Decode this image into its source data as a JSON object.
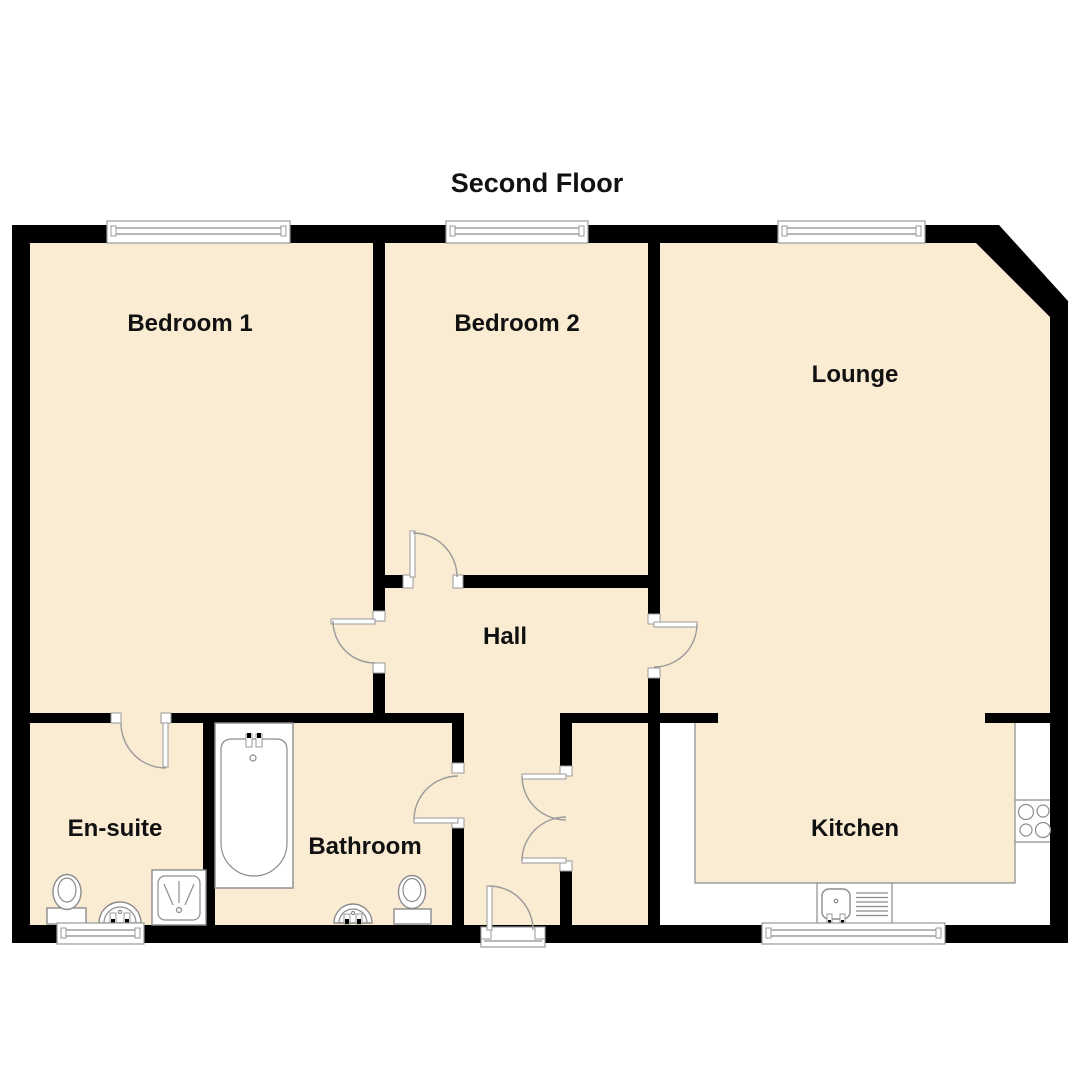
{
  "title": "Second Floor",
  "colors": {
    "floor": "#FAEBD3",
    "wall": "#000000",
    "background": "#FFFFFF",
    "fixture_outline": "#8C8C8C"
  },
  "rooms": {
    "bedroom1": {
      "label": "Bedroom 1"
    },
    "bedroom2": {
      "label": "Bedroom 2"
    },
    "lounge": {
      "label": "Lounge"
    },
    "hall": {
      "label": "Hall"
    },
    "ensuite": {
      "label": "En-suite"
    },
    "bathroom": {
      "label": "Bathroom"
    },
    "kitchen": {
      "label": "Kitchen"
    }
  },
  "fixtures": {
    "ensuite": [
      "toilet",
      "basin",
      "shower"
    ],
    "bathroom": [
      "bathtub",
      "basin",
      "toilet"
    ],
    "kitchen": [
      "counter",
      "sink",
      "drainer",
      "hob"
    ]
  },
  "openings": {
    "windows": [
      "bedroom1-window",
      "bedroom2-window",
      "lounge-window",
      "ensuite-window",
      "kitchen-window"
    ],
    "doors": [
      "ensuite-door",
      "bedroom1-door",
      "bedroom2-door",
      "lounge-door",
      "bathroom-door",
      "cupboard-double-door",
      "entrance-door"
    ]
  }
}
